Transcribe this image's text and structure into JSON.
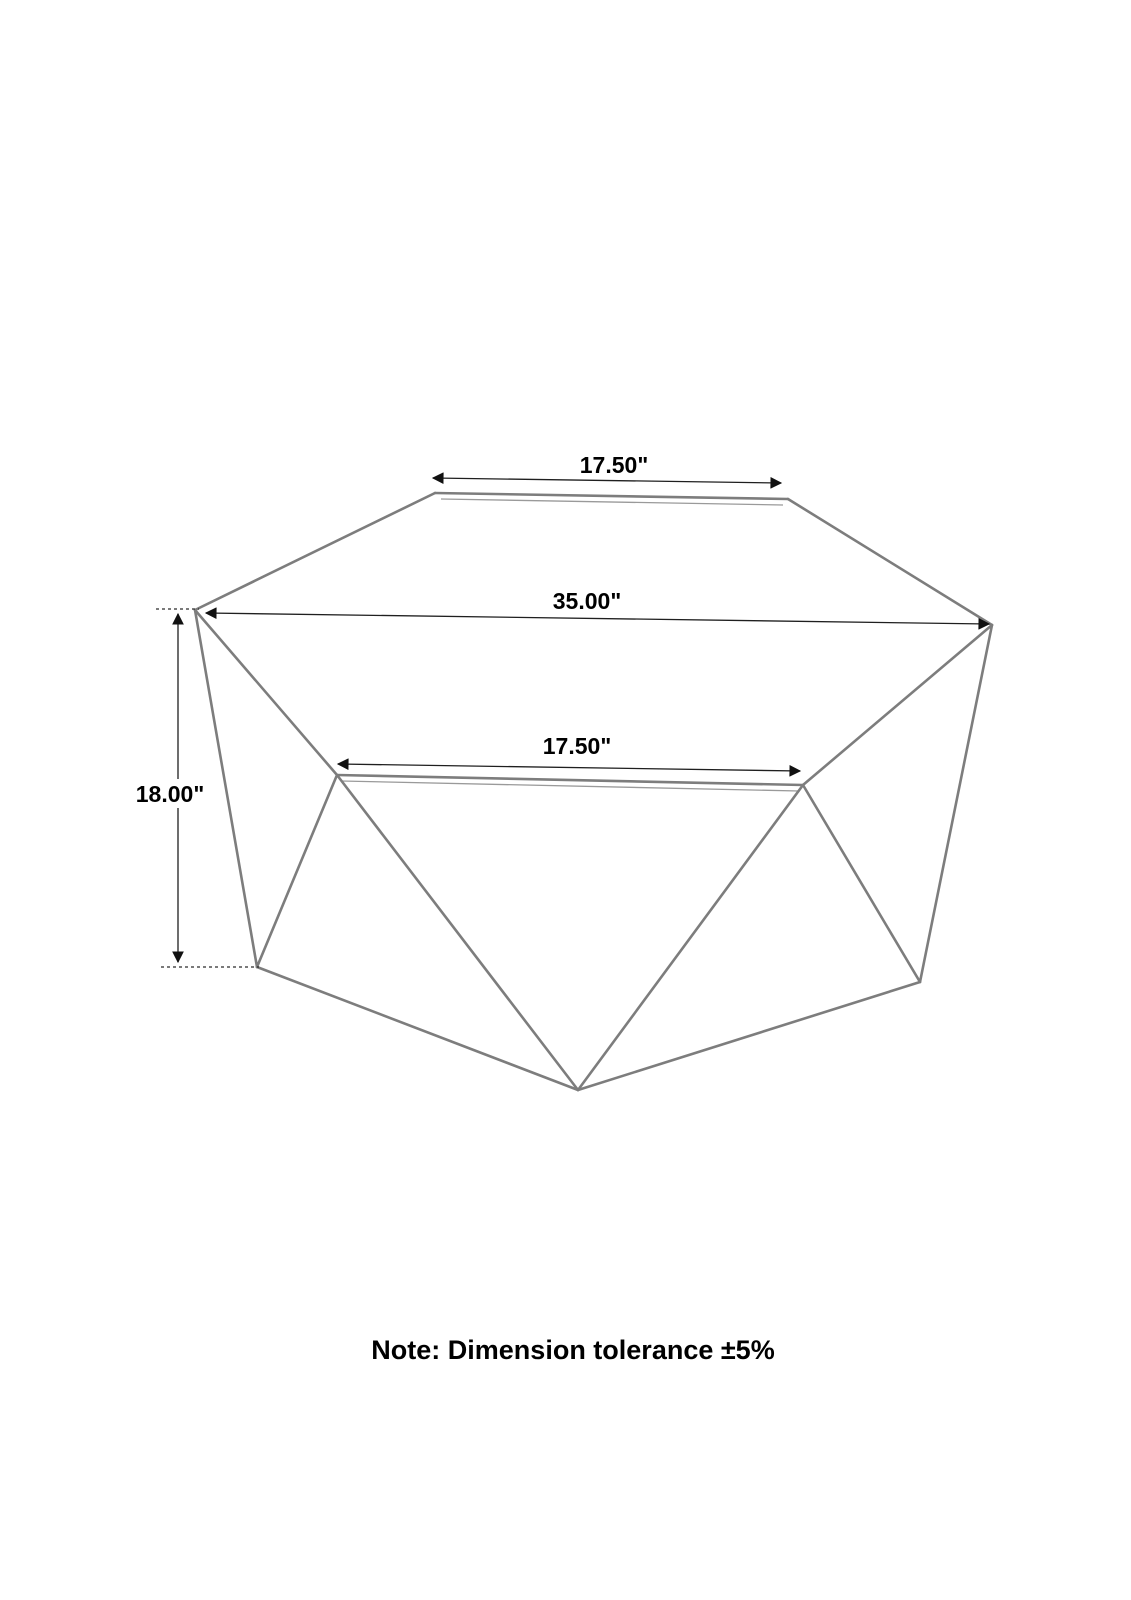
{
  "diagram": {
    "labels": {
      "top_width": "17.50\"",
      "overall_width": "35.00\"",
      "front_width": "17.50\"",
      "height": "18.00\""
    },
    "note": "Note: Dimension tolerance ±5%",
    "colors": {
      "background": "#ffffff",
      "edge": "#7d7d7d",
      "dimension_line": "#1f1f1f",
      "text": "#000000"
    }
  }
}
